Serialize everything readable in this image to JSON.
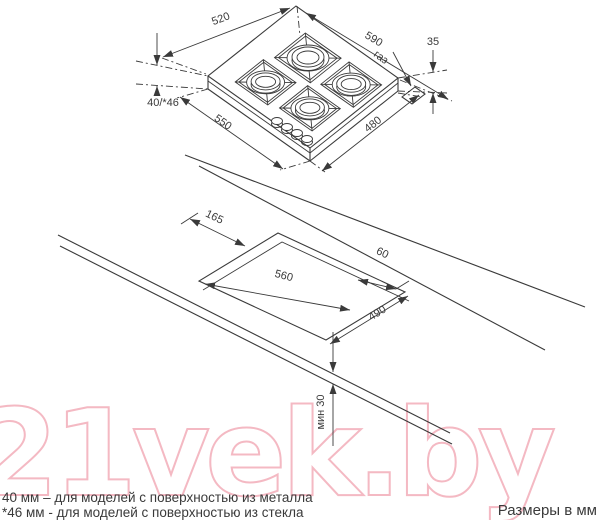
{
  "page": {
    "bg": "#ffffff",
    "ink": "#3a3a3a"
  },
  "watermark": {
    "text": "21vek.by",
    "color": "#f4b9c3"
  },
  "hob": {
    "dim_520": "520",
    "dim_590": "590",
    "dim_35": "35",
    "dim_height": "40/*46",
    "dim_550": "550",
    "dim_480": "480",
    "gas": "газ"
  },
  "cutout": {
    "dim_165": "165",
    "dim_560": "560",
    "dim_60": "60",
    "dim_490": "490",
    "dim_min30": "мин 30"
  },
  "footer": {
    "note1": "40 мм – для моделей с поверхностью  из металла",
    "note2": "*46 мм - для моделей с поверхностью  из стекла",
    "units": "Размеры в мм"
  }
}
